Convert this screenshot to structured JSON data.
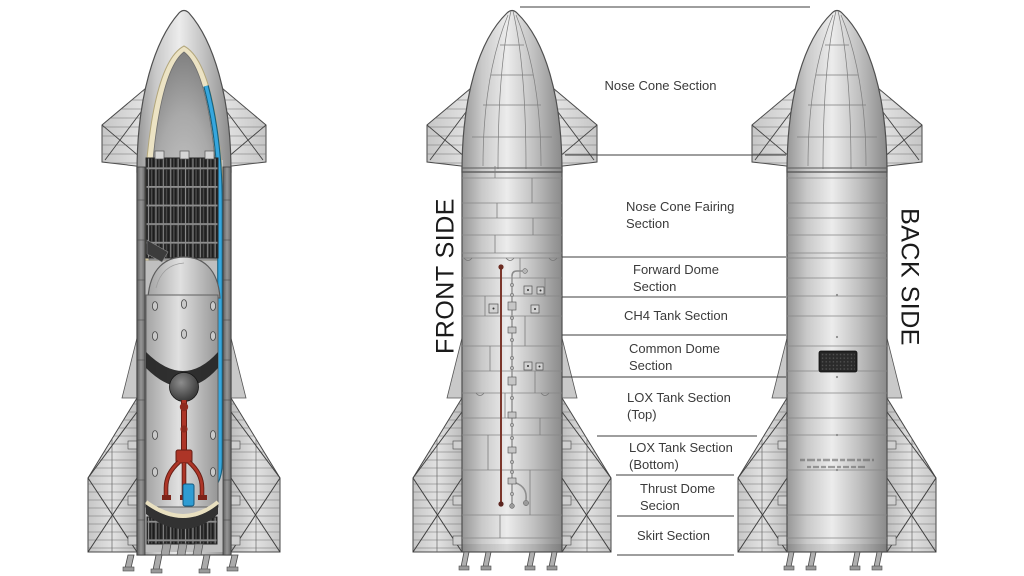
{
  "canvas": {
    "width": 1024,
    "height": 576,
    "background": "#ffffff"
  },
  "side_labels": {
    "front": "FRONT SIDE",
    "back": "BACK SIDE"
  },
  "sections": [
    {
      "label": "Nose Cone Section"
    },
    {
      "label": "Nose Cone Fairing Section"
    },
    {
      "label": "Forward Dome Section"
    },
    {
      "label": "CH4 Tank Section"
    },
    {
      "label": "Common Dome Section"
    },
    {
      "label": "LOX Tank Section (Top)"
    },
    {
      "label": "LOX Tank Section (Bottom)"
    },
    {
      "label": "Thrust Dome Secion"
    },
    {
      "label": "Skirt Section"
    }
  ],
  "colors": {
    "red_pipe": "#ad3527",
    "blue_pipe": "#36a7de",
    "cream_lining": "#ece3c4",
    "body_metal": "#c9c9c9",
    "rack_grid_dark": "#2d2d2d",
    "divider_line": "#3e3e3e",
    "label_text": "#3b3b3b"
  }
}
